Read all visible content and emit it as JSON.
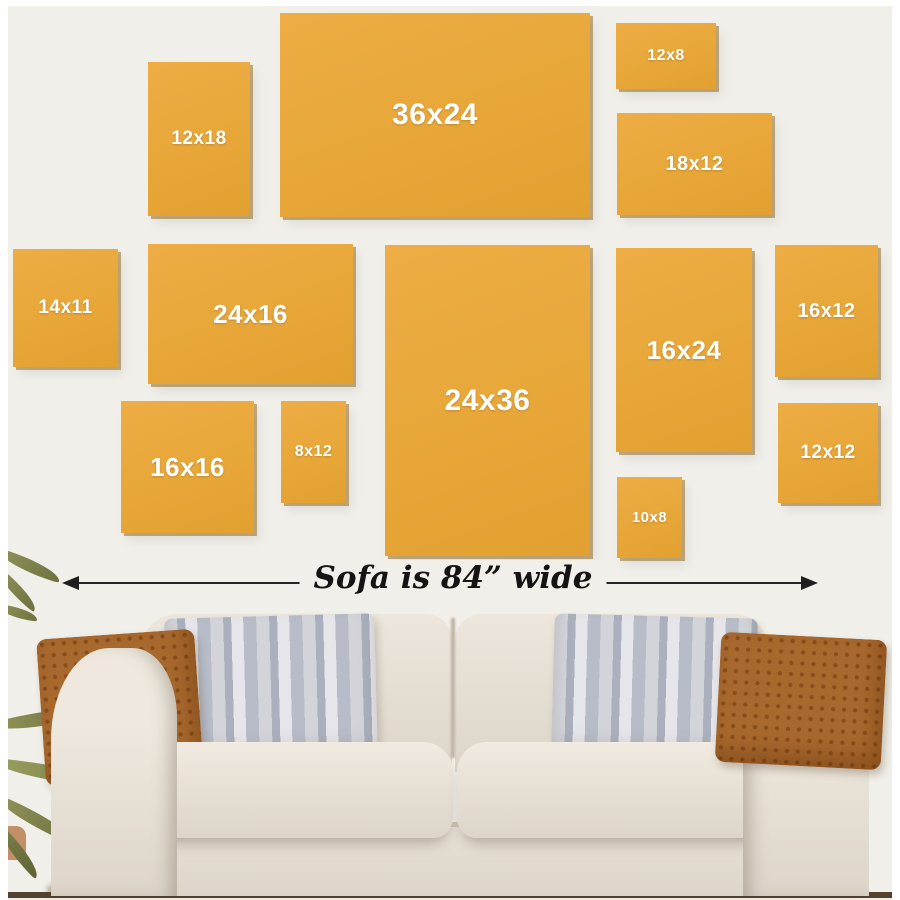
{
  "colors": {
    "wall": "#f1efe9",
    "frame_fill": "#e7a637",
    "frame_hi": "#eead45",
    "frame_lo": "#e2a031",
    "frame_edge": "rgba(150,110,35,0.55)",
    "label_text": "#ffffff",
    "arrow": "#1f1f1f",
    "rust_pillow": "#a8692e",
    "floor": "#54402c"
  },
  "frames": [
    {
      "label": "12x18",
      "x": 140,
      "y": 56,
      "w": 102,
      "h": 154,
      "fs": 19
    },
    {
      "label": "36x24",
      "x": 272,
      "y": 7,
      "w": 310,
      "h": 204,
      "fs": 30
    },
    {
      "label": "12x8",
      "x": 608,
      "y": 17,
      "w": 100,
      "h": 66,
      "fs": 16
    },
    {
      "label": "18x12",
      "x": 609,
      "y": 107,
      "w": 155,
      "h": 102,
      "fs": 20
    },
    {
      "label": "14x11",
      "x": 5,
      "y": 243,
      "w": 105,
      "h": 118,
      "fs": 19
    },
    {
      "label": "24x16",
      "x": 140,
      "y": 238,
      "w": 205,
      "h": 140,
      "fs": 26
    },
    {
      "label": "24x36",
      "x": 377,
      "y": 239,
      "w": 205,
      "h": 311,
      "fs": 30
    },
    {
      "label": "16x24",
      "x": 608,
      "y": 242,
      "w": 136,
      "h": 204,
      "fs": 26
    },
    {
      "label": "16x12",
      "x": 767,
      "y": 239,
      "w": 103,
      "h": 132,
      "fs": 20
    },
    {
      "label": "16x16",
      "x": 113,
      "y": 395,
      "w": 133,
      "h": 132,
      "fs": 26
    },
    {
      "label": "8x12",
      "x": 273,
      "y": 395,
      "w": 65,
      "h": 102,
      "fs": 16
    },
    {
      "label": "12x12",
      "x": 770,
      "y": 397,
      "w": 100,
      "h": 100,
      "fs": 19
    },
    {
      "label": "10x8",
      "x": 609,
      "y": 471,
      "w": 65,
      "h": 81,
      "fs": 15
    }
  ],
  "sofa": {
    "width_label": "Sofa is 84” wide"
  }
}
